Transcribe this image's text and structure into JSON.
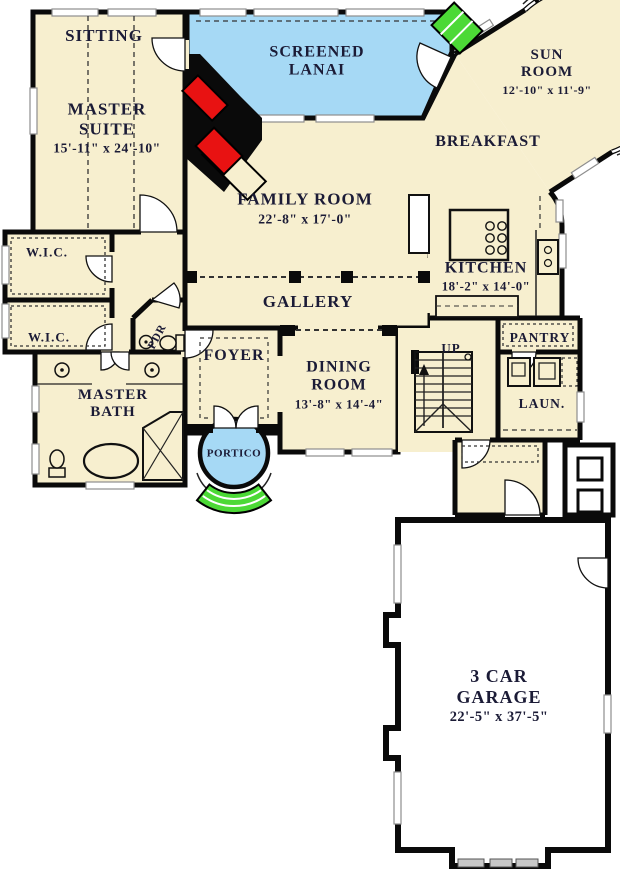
{
  "title": "First floor plan",
  "colors": {
    "floor": "#F7EFCF",
    "lanai": "#A6D9F5",
    "green": "#4CD936",
    "red": "#E81212",
    "wall": "#0a0a0a",
    "garage": "#FFFFFF",
    "text": "#1b1b36",
    "win": "#ffffff",
    "winstroke": "#8e8e8e"
  },
  "rooms": {
    "sitting": {
      "label": "SITTING"
    },
    "master_suite": {
      "label": "MASTER SUITE",
      "dims": "15'-11\" x 24'-10\""
    },
    "screened_lanai": {
      "label": "SCREENED LANAI"
    },
    "sun_room": {
      "label": "SUN ROOM",
      "dims": "12'-10\" x 11'-9\""
    },
    "breakfast": {
      "label": "BREAKFAST"
    },
    "family_room": {
      "label": "FAMILY ROOM",
      "dims": "22'-8\" x 17'-0\""
    },
    "kitchen": {
      "label": "KITCHEN",
      "dims": "18'-2\" x 14'-0\""
    },
    "wic_upper": {
      "label": "W.I.C."
    },
    "wic_lower": {
      "label": "W.I.C."
    },
    "powder": {
      "label": "PDR"
    },
    "gallery": {
      "label": "GALLERY"
    },
    "foyer": {
      "label": "FOYER"
    },
    "dining_room": {
      "label": "DINING ROOM",
      "dims": "13'-8\" x 14'-4\""
    },
    "master_bath": {
      "label": "MASTER BATH"
    },
    "portico": {
      "label": "PORTICO"
    },
    "pantry": {
      "label": "PANTRY"
    },
    "laundry": {
      "label": "LAUN."
    },
    "stairs": {
      "label": "UP"
    },
    "garage": {
      "label": "3 CAR GARAGE",
      "dims": "22'-5\" x 37'-5\""
    }
  }
}
